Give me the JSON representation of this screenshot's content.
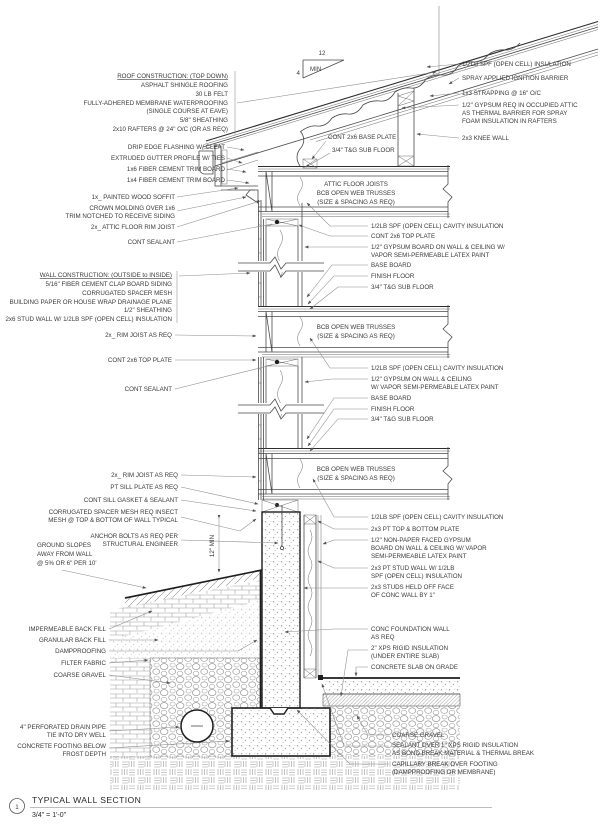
{
  "labels": {
    "roof_header": "ROOF CONSTRUCTION: (TOP DOWN)",
    "roof_1": "ASPHALT SHINGLE ROOFING",
    "roof_2": "30 LB FELT",
    "roof_3": "FULLY-ADHERED MEMBRANE WATERPROOFING",
    "roof_4": "(SINGLE COURSE AT EAVE)",
    "roof_5": "5/8\" SHEATHING",
    "roof_6": "2x10 RAFTERS @ 24\" O/C (OR AS REQ)",
    "drip_edge": "DRIP EDGE FLASHING W/ CLEAT",
    "gutter": "EXTRUDED GUTTER PROFILE W/ TIES",
    "trim_1x6": "1x6 FIBER CEMENT TRIM BOARD",
    "trim_1x4": "1x4 FIBER CEMENT TRIM BOARD",
    "soffit": "1x_ PAINTED WOOD SOFFIT",
    "crown_1": "CROWN MOLDING OVER 1x6",
    "crown_2": "TRIM NOTCHED TO RECEIVE SIDING",
    "attic_rim": "2x_ ATTIC FLOOR RIM JOIST",
    "sealant_1": "CONT SEALANT",
    "wall_header": "WALL CONSTRUCTION: (OUTSIDE to INSIDE)",
    "wall_1": "5/16\" FIBER CEMENT CLAP BOARD SIDING",
    "wall_2": "CORRUGATED SPACER MESH",
    "wall_3": "BUILDING PAPER OR HOUSE WRAP DRAINAGE PLANE",
    "wall_4": "1/2\" SHEATHING",
    "wall_5": "2x6 STUD WALL W/ 1/2LB SPF (OPEN CELL) INSULATION",
    "rim_2": "2x_ RIM JOIST AS REQ",
    "top_plate_2": "CONT 2x6 TOP PLATE",
    "sealant_2": "CONT SEALANT",
    "rim_3": "2x_ RIM JOIST AS REQ",
    "sill_plate": "PT SILL PLATE AS REQ",
    "sill_gasket": "CONT SILL GASKET & SEALANT",
    "spacer_mesh_1": "CORRUGATED SPACER MESH REQ INSECT",
    "spacer_mesh_2": "MESH @ TOP & BOTTOM OF WALL TYPICAL",
    "anchor_1": "ANCHOR BOLTS AS REQ PER",
    "anchor_2": "STRUCTURAL ENGINEER",
    "ground_1": "GROUND SLOPES",
    "ground_2": "AWAY FROM WALL",
    "ground_3": "@ 5% OR 6\" PER 10'",
    "backfill_imp": "IMPERMEABLE BACK FILL",
    "backfill_gran": "GRANULAR BACK FILL",
    "dampproofing": "DAMPPROOFING",
    "filter_fabric": "FILTER FABRIC",
    "coarse_gravel_l": "COARSE GRAVEL",
    "drain_1": "4\" PERFORATED DRAIN PIPE",
    "drain_2": "TIE INTO DRY WELL",
    "footing_1": "CONCRETE FOOTING BELOW",
    "footing_2": "FROST DEPTH",
    "spf_roof": "1/2LB SPF (OPEN CELL) INSULATION",
    "ignition": "SPRAY APPLIED IGNITION BARRIER",
    "strapping": "1x3 STRAPPING @ 16\" O/C",
    "gyp_attic_1": "1/2\" GYPSUM REQ IN OCCUPIED ATTIC",
    "gyp_attic_2": "AS THERMAL BARRIER FOR SPRAY",
    "gyp_attic_3": "FOAM INSULATION IN RAFTERS",
    "knee_wall": "2x3 KNEE WALL",
    "base_plate": "CONT 2x6 BASE PLATE",
    "subfloor_attic": "3/4\" T&G SUB FLOOR",
    "attic_joists_1": "ATTIC FLOOR JOISTS",
    "attic_joists_2": "BCB OPEN WEB TRUSSES",
    "attic_joists_3": "(SIZE & SPACING AS REQ)",
    "cavity_1": "1/2LB SPF (OPEN CELL) CAVITY INSULATION",
    "top_plate_r1": "CONT 2x6 TOP PLATE",
    "gyp_1a": "1/2\" GYPSUM BOARD ON WALL & CEILING W/",
    "gyp_1b": "VAPOR SEMI-PERMEABLE LATEX PAINT",
    "baseboard_1": "BASE BOARD",
    "finish_floor_1": "FINISH FLOOR",
    "subfloor_1": "3/4\" T&G SUB FLOOR",
    "trusses_2a": "BCB OPEN WEB TRUSSES",
    "trusses_2b": "(SIZE & SPACING AS REQ)",
    "cavity_2": "1/2LB SPF (OPEN CELL) CAVITY INSULATION",
    "gyp_2a": "1/2\" GYPSUM ON WALL & CEILING",
    "gyp_2b": "W/ VAPOR SEMI-PERMEABLE LATEX PAINT",
    "baseboard_2": "BASE BOARD",
    "finish_floor_2": "FINISH FLOOR",
    "subfloor_2": "3/4\" T&G SUB FLOOR",
    "trusses_3a": "BCB OPEN WEB TRUSSES",
    "trusses_3b": "(SIZE & SPACING AS REQ)",
    "cavity_3": "1/2LB SPF (OPEN CELL) CAVITY INSULATION",
    "pt_plate": "2x3 PT TOP & BOTTOM PLATE",
    "gyp_3a": "1/2\" NON-PAPER FACED GYPSUM",
    "gyp_3b": "BOARD ON WALL & CEILING W/ VAPOR",
    "gyp_3c": "SEMI-PERMEABLE LATEX PAINT",
    "pt_stud_1": "2x3 PT STUD WALL W/ 1/2LB",
    "pt_stud_2": "SPF (OPEN CELL) INSULATION",
    "studs_off_1": "2x3 STUDS HELD OFF FACE",
    "studs_off_2": "OF CONC WALL BY 1\"",
    "fdn_wall_1": "CONC FOUNDATION WALL",
    "fdn_wall_2": "AS REQ",
    "xps_1": "2\" XPS RIGID INSULATION",
    "xps_2": "(UNDER ENTIRE SLAB)",
    "slab": "CONCRETE SLAB ON GRADE",
    "coarse_gravel_r": "COARSE GRAVEL",
    "sealant_xps_1": "SEALANT OVER 1\" XPS RIGID INSULATION",
    "sealant_xps_2": "AS BOND BREAK MATERIAL & THERMAL BREAK",
    "capillary_1": "CAPILLARY BREAK OVER FOOTING",
    "capillary_2": "(DAMPPROOFING OR MEMBRANE)"
  },
  "slope_marker": {
    "run": "12",
    "rise": "4",
    "note": "MIN"
  },
  "dimensions": {
    "foundation_exposure": "12\" MIN"
  },
  "title_block": {
    "detail_number": "1",
    "title": "TYPICAL WALL SECTION",
    "scale": "3/4\" = 1'-0\""
  }
}
